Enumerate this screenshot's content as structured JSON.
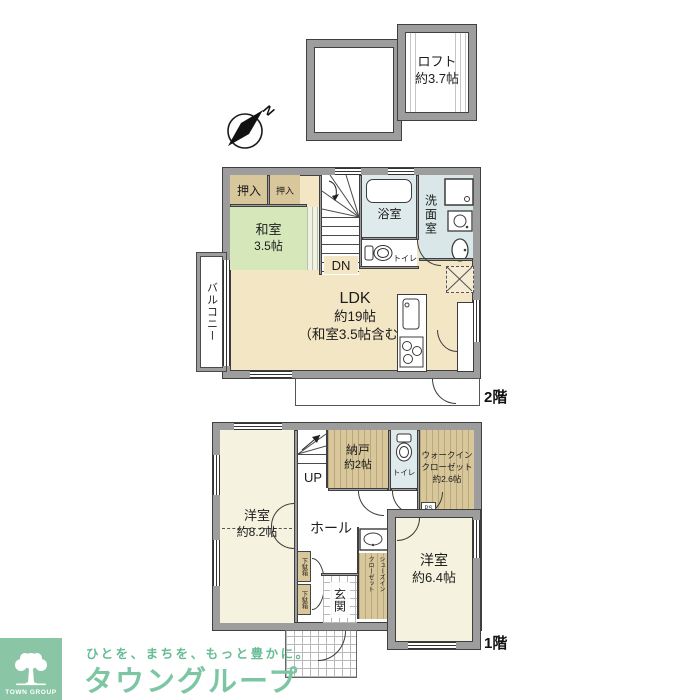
{
  "palette": {
    "wall_gray": "#9d9d9d",
    "ldk_beige": "#f3e6c4",
    "washitsu_green": "#d6e8ba",
    "closet_tan": "#d8c79b",
    "bedroom_cream": "#f5f3df",
    "sanitary_blue": "#dfeaec",
    "brand_green": "#7cc6a4"
  },
  "compass": {
    "north": "N"
  },
  "loft": {
    "name": "ロフト",
    "size": "約3.7帖"
  },
  "floor2": {
    "label": "2階",
    "closet_a": "押入",
    "closet_b": "押入",
    "washitsu": {
      "name": "和室",
      "size": "3.5帖"
    },
    "stairs_down": "DN",
    "bathroom": "浴室",
    "washroom": "洗面室",
    "toilet": "トイレ",
    "ldk": {
      "name": "LDK",
      "size": "約19帖",
      "note": "（和室3.5帖含む）"
    },
    "balcony": "バルコニー"
  },
  "floor1": {
    "label": "1階",
    "bedroom_a": {
      "name": "洋室",
      "size": "約8.2帖"
    },
    "stairs_up": "UP",
    "storage": {
      "name": "納戸",
      "size": "約2帖"
    },
    "toilet": "トイレ",
    "wic": {
      "line1": "ウォークイン",
      "line2": "クローゼット",
      "size": "約2.6帖"
    },
    "ps": "PS",
    "hall": "ホール",
    "shoe_closet": {
      "line1": "シューズイン",
      "line2": "クローゼット"
    },
    "shoe_box_a": "下駄箱",
    "shoe_box_b": "下駄箱",
    "entrance": "玄関",
    "bedroom_b": {
      "name": "洋室",
      "size": "約6.4帖"
    }
  },
  "branding": {
    "logo": "TOWN GROUP",
    "tagline": "ひとを、まちを、もっと豊かに。",
    "company": "タウングループ"
  }
}
